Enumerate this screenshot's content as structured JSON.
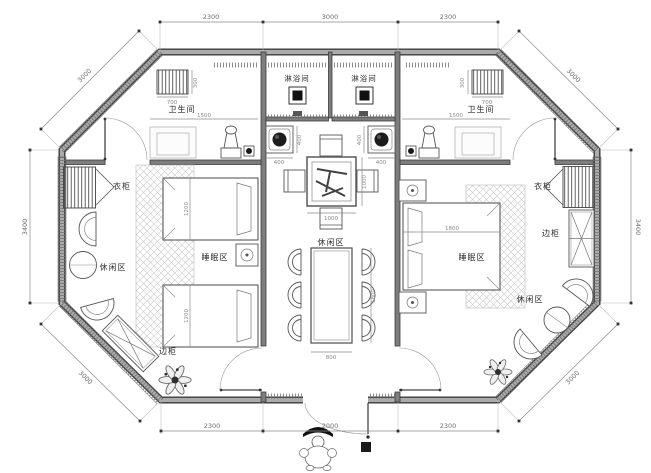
{
  "plan": {
    "labels": {
      "shower": "淋浴间",
      "bathroom": "卫生间",
      "wardrobe": "衣柜",
      "sleep_area": "睡眠区",
      "leisure_area": "休闲区",
      "side_cabinet": "边柜"
    },
    "dimensions": {
      "top": [
        "2300",
        "3000",
        "2300"
      ],
      "bottom": [
        "2300",
        "2000",
        "2300"
      ],
      "side_left": "3400",
      "side_right": "3400",
      "diagonal": "3000",
      "bathroom_width": "1500",
      "towel_rack_width": "700",
      "towel_rack_depth": "300",
      "washbasin": "400",
      "single_bed_width": "1200",
      "double_bed_width": "1800",
      "tea_table": "1000",
      "dining_table_width": "800",
      "dining_table_length": "1800"
    },
    "colors": {
      "background": "#ffffff",
      "wall_edge": "#3d3d3d",
      "wall_fill": "#ababab",
      "furniture_line": "#555555",
      "dim_line": "#8a8a8a",
      "dim_text": "#6e6e6e",
      "label_text": "#2b2b2b",
      "drain_fill": "#1a1a1a",
      "carpet_hatch": "#c9c9c9"
    }
  }
}
